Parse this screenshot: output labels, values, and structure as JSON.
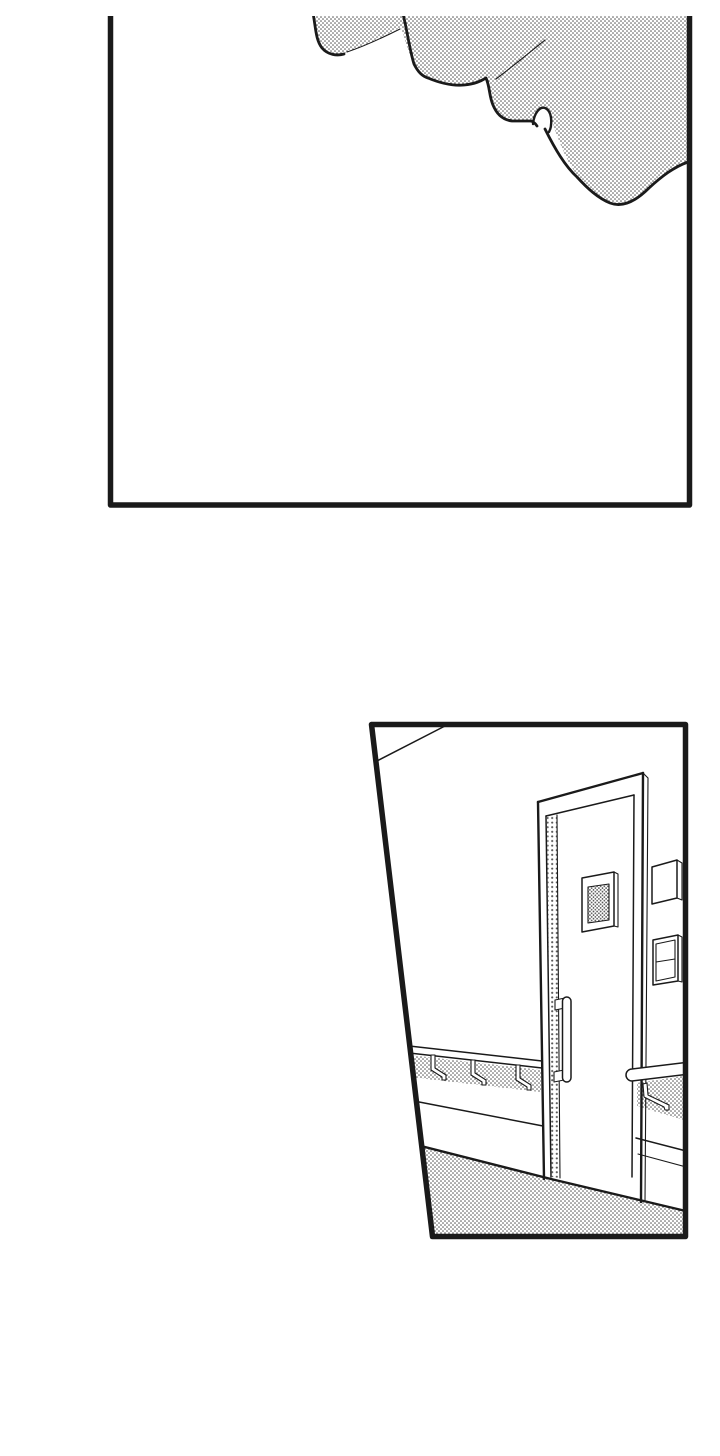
{
  "page": {
    "label": "Black-and-white manga page with two wordless panels",
    "background": "#ffffff"
  },
  "colors": {
    "ink": "#1a1a1a",
    "paper": "#ffffff",
    "tone_dot": "#515151"
  },
  "panels": [
    {
      "id": "top-panel",
      "label": "Tall rectangular panel, mostly blank white; a screentoned wavy shape like bedding or a cloud fills the upper-right corner, with thin crease lines"
    },
    {
      "id": "bottom-panel",
      "label": "Trapezoid panel of a hallway: a door with a small screentoned window and a vertical bar handle, a blank wall sign and a two-cell switch panel beside the door, handrails with brackets along both walls, and a screentoned floor"
    }
  ]
}
